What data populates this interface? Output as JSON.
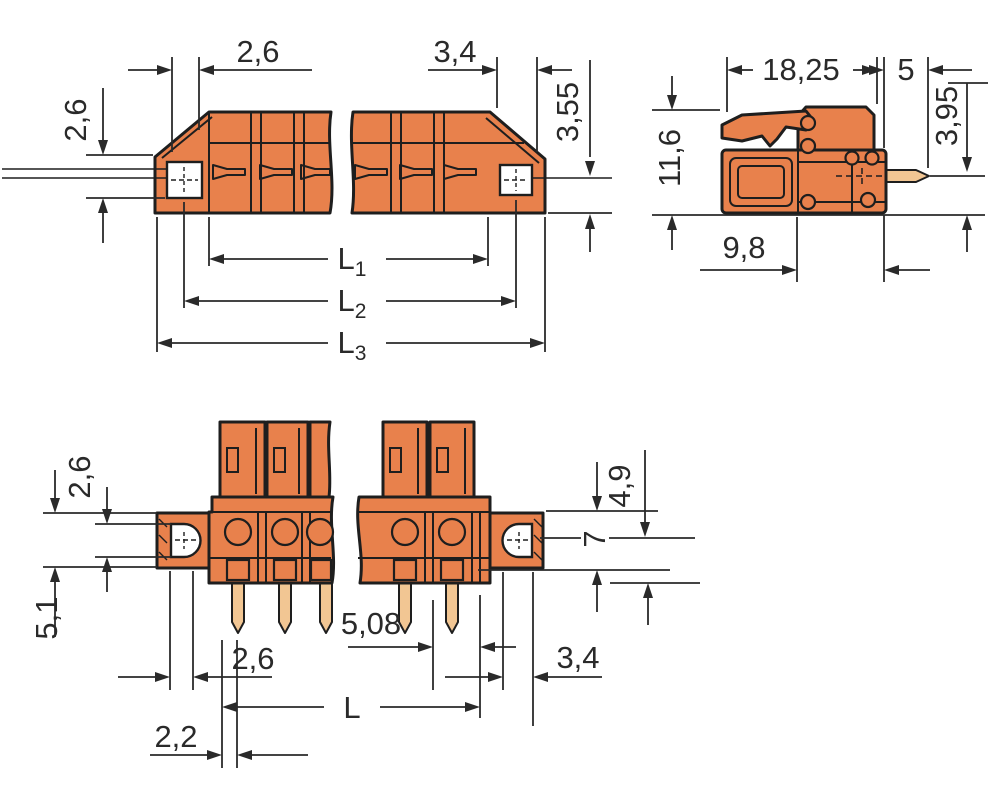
{
  "colors": {
    "body_orange": "#E8814C",
    "pin_copper": "#F2C693",
    "outline": "#1E1E1E",
    "dimension": "#2A2A2A",
    "background": "#FFFFFF"
  },
  "front_view": {
    "dim_top_left": "2,6",
    "dim_top_right": "3,4",
    "dim_side_left": "2,6",
    "dim_side_right": "3,55",
    "dim_l1_base": "L",
    "dim_l1_sub": "1",
    "dim_l2_base": "L",
    "dim_l2_sub": "2",
    "dim_l3_base": "L",
    "dim_l3_sub": "3"
  },
  "side_view": {
    "dim_width": "18,25",
    "dim_pin": "5",
    "dim_height": "11,6",
    "dim_pin_drop": "3,95",
    "dim_depth": "9,8"
  },
  "bottom_view": {
    "dim_left_top": "2,6",
    "dim_left_bottom": "5,1",
    "dim_right_top": "4,9",
    "dim_right_center": "7",
    "dim_pitch": "5,08",
    "dim_bottom_left": "2,6",
    "dim_bottom_right": "3,4",
    "dim_length": "L",
    "dim_offset": "2,2"
  }
}
